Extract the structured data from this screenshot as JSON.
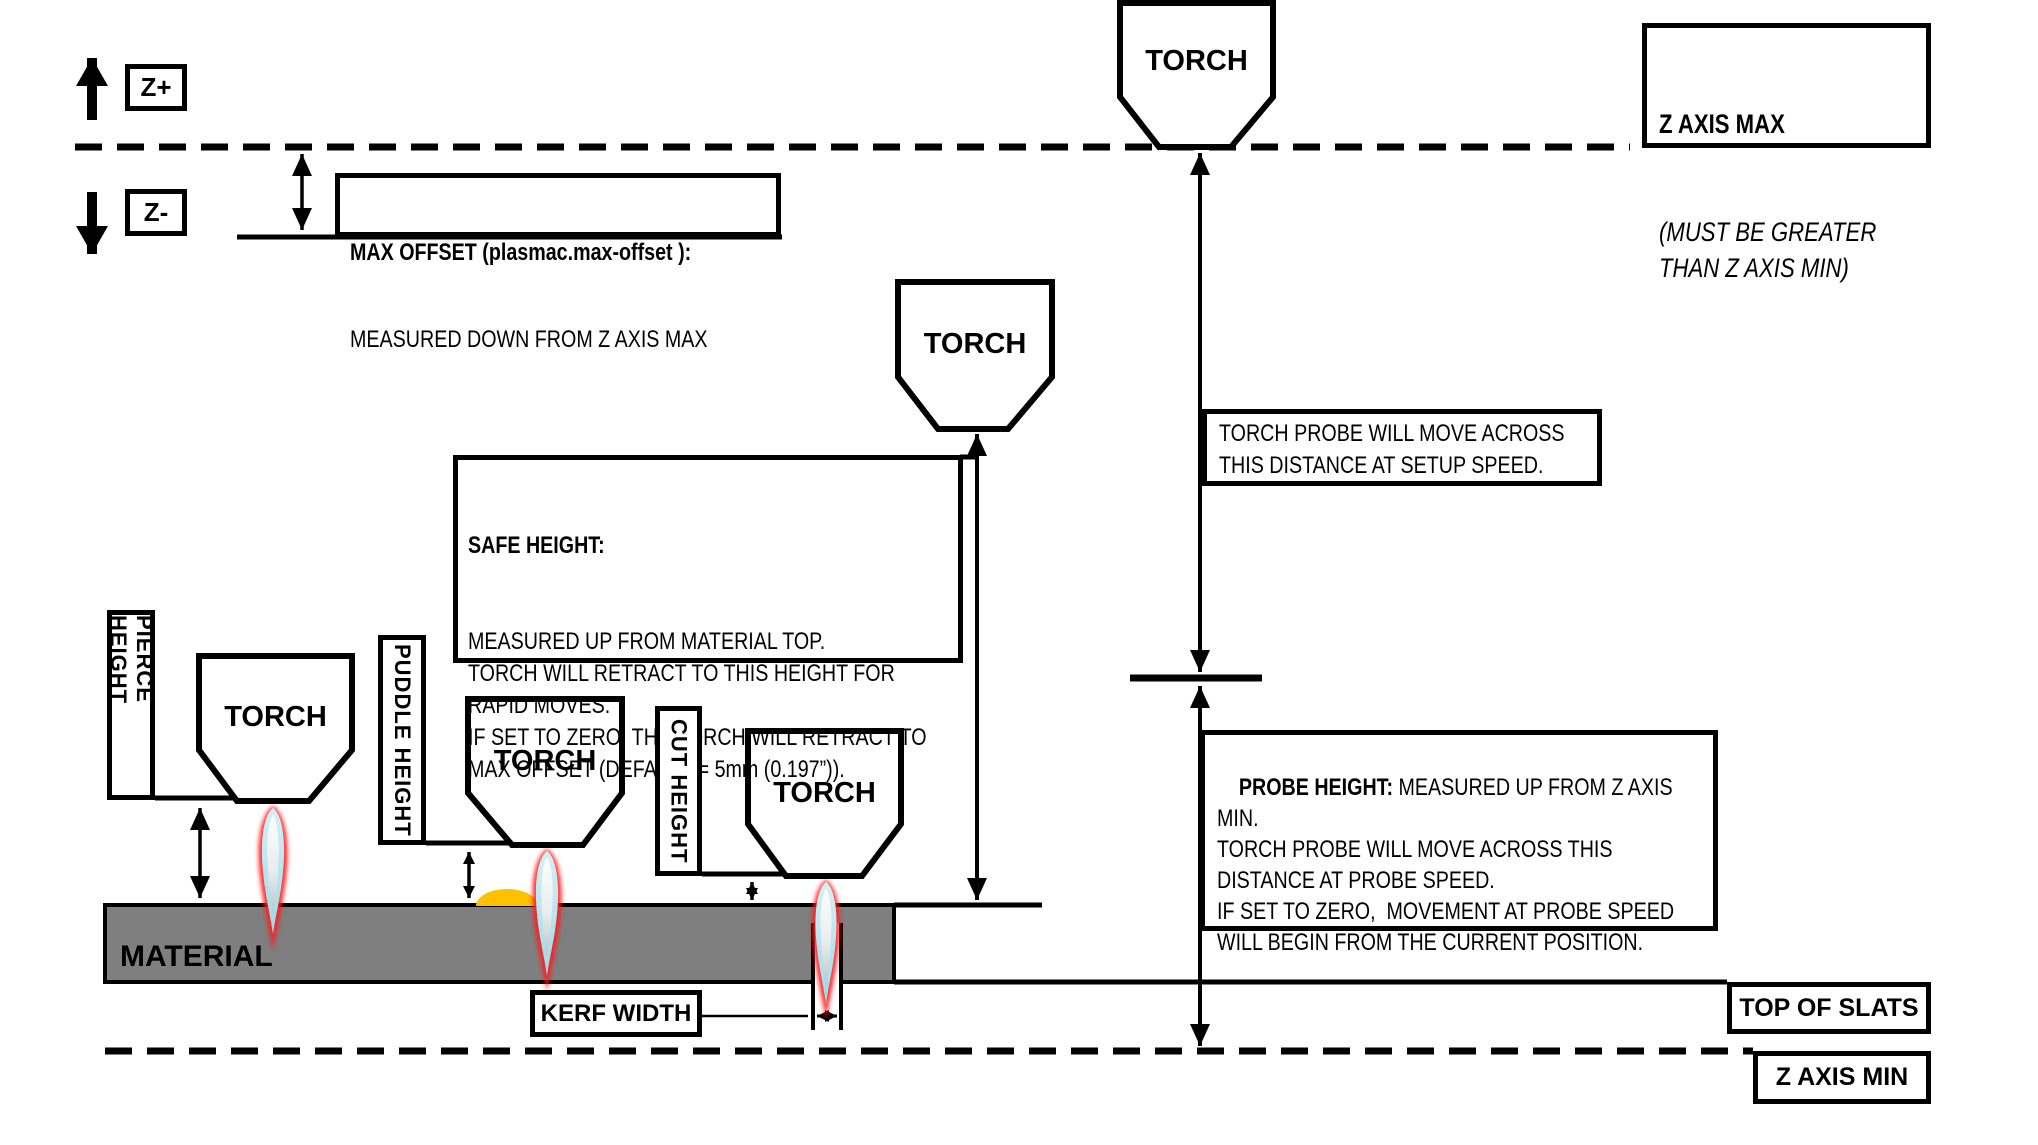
{
  "colors": {
    "background": "#ffffff",
    "line": "#000000",
    "material_fill": "#7f7f7f",
    "puddle_fill": "#ffc000",
    "flame_outer": "#ff1f1f",
    "flame_mid": "#aee1ee",
    "flame_core_top": "#fdfefe",
    "flame_core_tip": "#b9c2c6"
  },
  "axis_legend": {
    "up_label": "Z+",
    "down_label": "Z-"
  },
  "torch_label": "TORCH",
  "material_label": "MATERIAL",
  "height_labels": {
    "pierce": "PIERCE HEIGHT",
    "puddle": "PUDDLE HEIGHT",
    "cut": "CUT HEIGHT"
  },
  "callouts": {
    "max_offset_title": "MAX OFFSET (plasmac.max-offset ):",
    "max_offset_body": "MEASURED DOWN FROM Z AXIS MAX",
    "z_axis_max_title": "Z AXIS MAX",
    "z_axis_max_body": "(MUST BE GREATER\nTHAN Z AXIS MIN)",
    "safe_height_title": "SAFE HEIGHT:",
    "safe_height_body": "MEASURED UP FROM MATERIAL TOP.\nTORCH WILL RETRACT TO THIS HEIGHT FOR\nRAPID MOVES.\nIF SET TO ZERO, THE TORCH WILL RETRACT TO\nMAX OFFSET (DEFAULT = 5mm (0.197”)).",
    "torch_probe_body": "TORCH PROBE WILL MOVE ACROSS\nTHIS DISTANCE AT SETUP SPEED.",
    "probe_height_title": "PROBE HEIGHT:",
    "probe_height_body": " MEASURED UP FROM Z AXIS\nMIN.\nTORCH PROBE WILL MOVE ACROSS THIS\nDISTANCE AT PROBE SPEED.\nIF SET TO ZERO,  MOVEMENT AT PROBE SPEED\nWILL BEGIN FROM THE CURRENT POSITION.",
    "kerf_width": "KERF WIDTH",
    "top_of_slats": "TOP OF SLATS",
    "z_axis_min": "Z AXIS MIN"
  }
}
